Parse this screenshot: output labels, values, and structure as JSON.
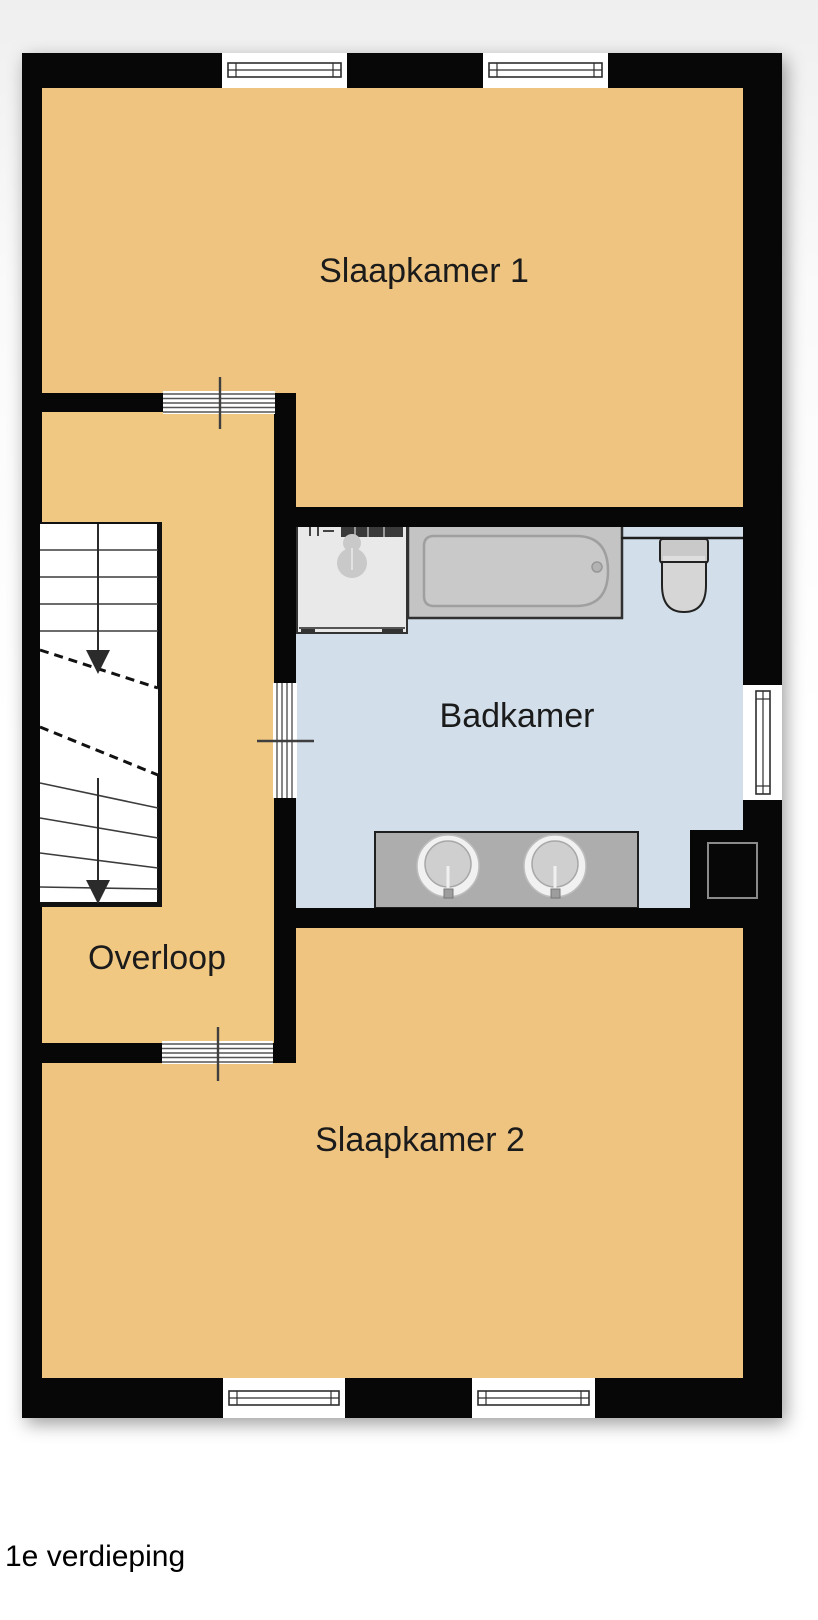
{
  "caption": "1e verdieping",
  "labels": {
    "slaapkamer1": "Slaapkamer 1",
    "badkamer": "Badkamer",
    "overloop": "Overloop",
    "slaapkamer2": "Slaapkamer 2"
  },
  "colors": {
    "wall": "#070707",
    "floor_bedroom1": "#EEC480",
    "floor_bedroom2": "#EEC480",
    "floor_landing": "#F1C881",
    "floor_bathroom": "#D2DFEA",
    "stairs_fill": "#FFFFFF",
    "window_fill": "#FFFFFF",
    "washer_fill": "#E9E9E9",
    "tub_fill": "#C4C4C4",
    "tub_inner": "#C9C9C9",
    "toilet_fill": "#C9C9C9",
    "vanity_fill": "#ADADAD",
    "sink_ring": "#F1F1F1",
    "sink_bowl": "#CFCFCF",
    "shaft_outline": "#8A8A8A"
  },
  "fixtures": [
    "staircase-down",
    "washing-machine",
    "bathtub",
    "toilet",
    "double-sink-vanity",
    "duct-shaft",
    "window",
    "door-opening"
  ]
}
